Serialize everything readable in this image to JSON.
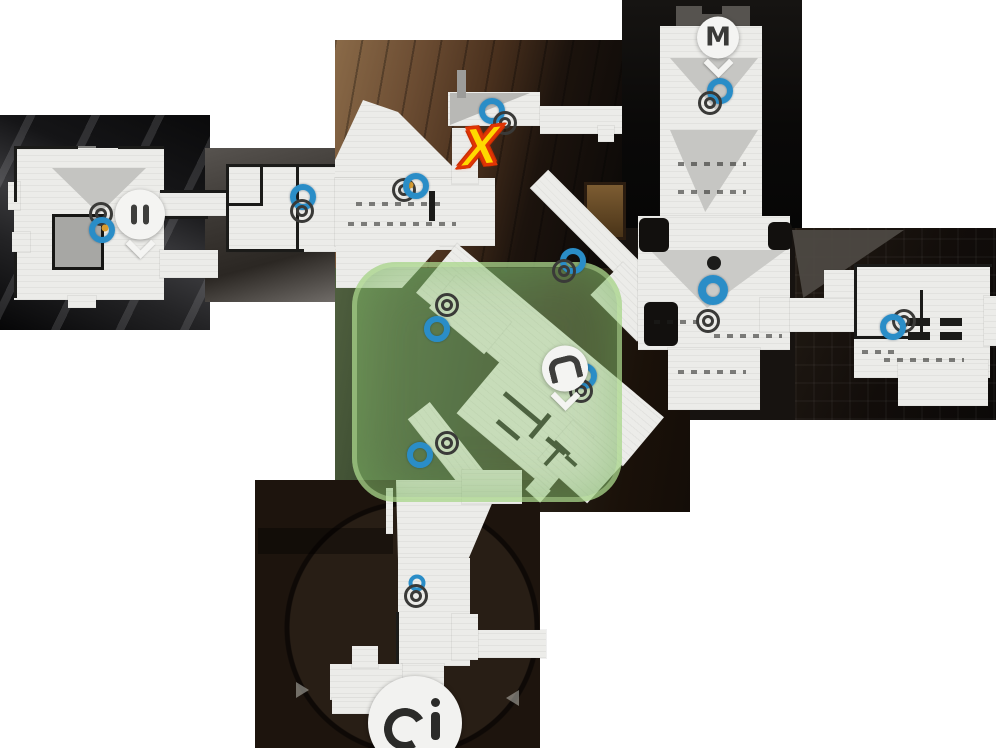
{
  "map": {
    "annotation": {
      "text": "X",
      "x": 481,
      "y": 148
    },
    "pins": [
      {
        "id": "metro-pin",
        "label": "M",
        "x": 718,
        "y": 45
      },
      {
        "id": "exit-pin",
        "label": "",
        "x": 140,
        "y": 222
      },
      {
        "id": "objective-pin",
        "label": "",
        "x": 565,
        "y": 376
      },
      {
        "id": "lock-marker",
        "label": "",
        "x": 415,
        "y": 723
      }
    ],
    "colors": {
      "marker_blue": "#2a8dc7",
      "marker_gray": "#3a3a38",
      "zone_green": "rgba(148,198,120,0.42)",
      "x_fill": "#ffd900",
      "x_outline": "#e03505",
      "floor": "#ecece9"
    },
    "markers": [
      {
        "type": "ring-gray",
        "x": 101,
        "y": 214
      },
      {
        "type": "ring-blue",
        "x": 102,
        "y": 230
      },
      {
        "type": "dot-gold",
        "x": 105,
        "y": 228
      },
      {
        "type": "ring-blue",
        "x": 303,
        "y": 197
      },
      {
        "type": "ring-gray",
        "x": 302,
        "y": 211
      },
      {
        "type": "ring-gray",
        "x": 404,
        "y": 190
      },
      {
        "type": "dot-gold",
        "x": 410,
        "y": 185
      },
      {
        "type": "ring-blue",
        "x": 416,
        "y": 186
      },
      {
        "type": "ring-blue",
        "x": 492,
        "y": 111
      },
      {
        "type": "ring-gray",
        "x": 505,
        "y": 123
      },
      {
        "type": "ring-blue",
        "x": 573,
        "y": 261
      },
      {
        "type": "ring-gray",
        "x": 564,
        "y": 271
      },
      {
        "type": "ring-blue",
        "x": 720,
        "y": 91
      },
      {
        "type": "ring-gray",
        "x": 710,
        "y": 103
      },
      {
        "type": "dot-black",
        "x": 714,
        "y": 263
      },
      {
        "type": "ring-blue-large",
        "x": 713,
        "y": 290
      },
      {
        "type": "ring-gray",
        "x": 708,
        "y": 321
      },
      {
        "type": "ring-gray",
        "x": 904,
        "y": 321
      },
      {
        "type": "ring-blue",
        "x": 893,
        "y": 327
      },
      {
        "type": "ring-blue",
        "x": 584,
        "y": 376
      },
      {
        "type": "ring-gray",
        "x": 581,
        "y": 391
      },
      {
        "type": "ring-gray",
        "x": 447,
        "y": 305
      },
      {
        "type": "ring-blue",
        "x": 437,
        "y": 329
      },
      {
        "type": "ring-blue",
        "x": 420,
        "y": 455
      },
      {
        "type": "ring-gray",
        "x": 447,
        "y": 443
      },
      {
        "type": "ring-blue-small",
        "x": 417,
        "y": 583
      },
      {
        "type": "ring-gray",
        "x": 416,
        "y": 596
      }
    ]
  }
}
